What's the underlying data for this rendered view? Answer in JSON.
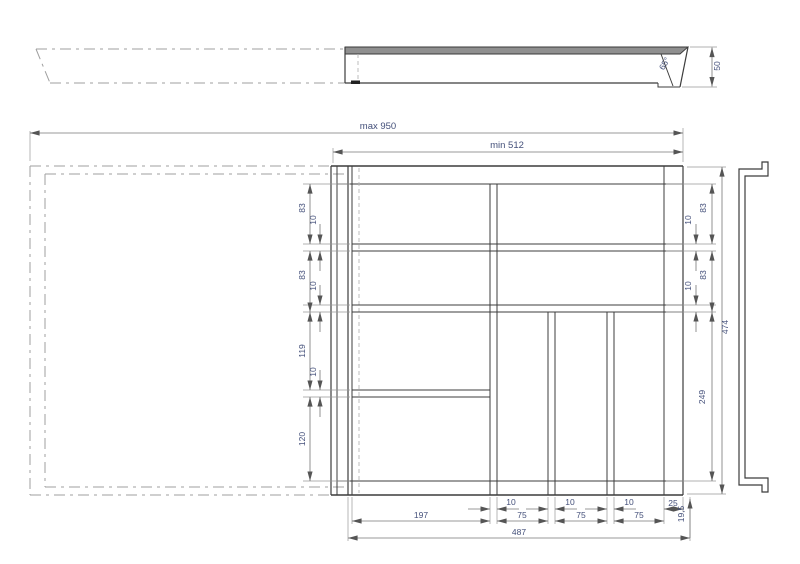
{
  "side_view": {
    "angle": "65°",
    "height": "50"
  },
  "plan": {
    "max_width": "max 950",
    "min_width": "min 512"
  },
  "left_chain": {
    "c1": "83",
    "g1": "10",
    "c2": "83",
    "g2": "10",
    "c3": "119",
    "g3": "10",
    "c4": "120"
  },
  "right_chain": {
    "c1": "83",
    "g1": "10",
    "c2": "83",
    "g2": "10",
    "pocket": "249",
    "height": "474"
  },
  "bottom_chain": {
    "g1": "10",
    "g2": "10",
    "g3": "10",
    "wall": "25",
    "s1": "197",
    "s2": "75",
    "s3": "75",
    "s4": "75",
    "lip": "19,5",
    "width": "487"
  }
}
